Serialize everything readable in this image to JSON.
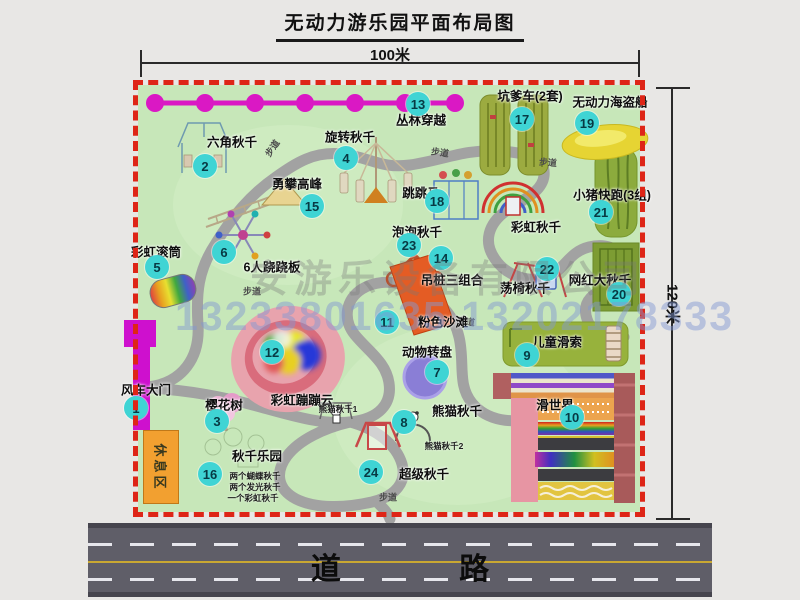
{
  "header": {
    "title": "无动力游乐园平面布局图"
  },
  "dimensions": {
    "width_label": "100米",
    "height_label": "120米"
  },
  "watermark": {
    "company": "安游乐设备有限公司",
    "phone": "13233801635 13202178333"
  },
  "road": {
    "label": "道 路"
  },
  "colors": {
    "badge": "#3fd4d4",
    "border_red": "#de2517",
    "park_green": "#c7e7b9",
    "gate_magenta": "#ce10ce",
    "road_gray": "#5f5e68",
    "rest_orange": "#f2a030"
  },
  "park": {
    "rest_area_label": "休息区",
    "walkway_label": "步道",
    "attractions": [
      {
        "num": "1",
        "label": "风车大门",
        "badge": {
          "x": -2,
          "y": 323
        },
        "label_pos": {
          "x": 8,
          "y": 304
        }
      },
      {
        "num": "2",
        "label": "六角秋千",
        "badge": {
          "x": 67,
          "y": 81
        },
        "label_pos": {
          "x": 94,
          "y": 56
        }
      },
      {
        "num": "3",
        "label": "樱花树",
        "badge": {
          "x": 79,
          "y": 336
        },
        "label_pos": {
          "x": 86,
          "y": 319
        }
      },
      {
        "num": "4",
        "label": "旋转秋千",
        "badge": {
          "x": 208,
          "y": 73
        },
        "label_pos": {
          "x": 212,
          "y": 51
        }
      },
      {
        "num": "5",
        "label": "彩虹滚筒",
        "badge": {
          "x": 19,
          "y": 182
        },
        "label_pos": {
          "x": 18,
          "y": 166
        }
      },
      {
        "num": "6",
        "label": "6人跷跷板",
        "badge": {
          "x": 86,
          "y": 167
        },
        "label_pos": {
          "x": 134,
          "y": 181
        }
      },
      {
        "num": "7",
        "label": "动物转盘",
        "badge": {
          "x": 299,
          "y": 287
        },
        "label_pos": {
          "x": 289,
          "y": 266
        }
      },
      {
        "num": "8",
        "label": "熊猫秋千",
        "badge": {
          "x": 266,
          "y": 337
        },
        "label_pos": {
          "x": 319,
          "y": 325
        }
      },
      {
        "num": "9",
        "label": "儿童滑索",
        "badge": {
          "x": 389,
          "y": 270
        },
        "label_pos": {
          "x": 419,
          "y": 256
        }
      },
      {
        "num": "10",
        "label": "滑世界",
        "badge": {
          "x": 434,
          "y": 332
        },
        "label_pos": {
          "x": 417,
          "y": 319
        }
      },
      {
        "num": "11",
        "label": "粉色沙滩",
        "badge": {
          "x": 249,
          "y": 237
        },
        "label_pos": {
          "x": 305,
          "y": 236
        }
      },
      {
        "num": "12",
        "label": "彩虹蹦蹦云",
        "badge": {
          "x": 134,
          "y": 267
        },
        "label_pos": {
          "x": 164,
          "y": 314
        }
      },
      {
        "num": "13",
        "label": "丛林穿越",
        "badge": {
          "x": 280,
          "y": 19
        },
        "label_pos": {
          "x": 283,
          "y": 34
        }
      },
      {
        "num": "14",
        "label": "吊桩三组合",
        "badge": {
          "x": 303,
          "y": 173
        },
        "label_pos": {
          "x": 314,
          "y": 194
        }
      },
      {
        "num": "15",
        "label": "勇攀高峰",
        "badge": {
          "x": 174,
          "y": 121
        },
        "label_pos": {
          "x": 159,
          "y": 98
        }
      },
      {
        "num": "16",
        "label": "秋千乐园",
        "badge": {
          "x": 72,
          "y": 389
        },
        "label_pos": {
          "x": 119,
          "y": 370
        }
      },
      {
        "num": "17",
        "label": "坑爹车(2套)",
        "badge": {
          "x": 384,
          "y": 34
        },
        "label_pos": {
          "x": 392,
          "y": 10
        }
      },
      {
        "num": "18",
        "label": "跳跳马",
        "badge": {
          "x": 299,
          "y": 116
        },
        "label_pos": {
          "x": 283,
          "y": 107
        }
      },
      {
        "num": "19",
        "label": "无动力海盗船",
        "badge": {
          "x": 449,
          "y": 38
        },
        "label_pos": {
          "x": 472,
          "y": 16
        }
      },
      {
        "num": "20",
        "label": "网红大秋千",
        "badge": {
          "x": 481,
          "y": 209
        },
        "label_pos": {
          "x": 462,
          "y": 194
        }
      },
      {
        "num": "21",
        "label": "小猪快跑(3组)",
        "badge": {
          "x": 463,
          "y": 127
        },
        "label_pos": {
          "x": 474,
          "y": 109
        }
      },
      {
        "num": "22",
        "label": "荡椅秋千",
        "badge": {
          "x": 409,
          "y": 184
        },
        "label_pos": {
          "x": 387,
          "y": 202
        }
      },
      {
        "num": "23",
        "label": "泡泡秋千",
        "badge": {
          "x": 271,
          "y": 160
        },
        "label_pos": {
          "x": 279,
          "y": 146
        }
      },
      {
        "num": "24",
        "label": "超级秋千",
        "badge": {
          "x": 233,
          "y": 387
        },
        "label_pos": {
          "x": 286,
          "y": 388
        }
      },
      {
        "num": null,
        "label": "彩虹秋千",
        "badge": null,
        "label_pos": {
          "x": 398,
          "y": 141
        }
      }
    ],
    "annotations": [
      {
        "text": "熊猫秋千1",
        "x": 200,
        "y": 324
      },
      {
        "text": "熊猫秋千2",
        "x": 306,
        "y": 361
      },
      {
        "text": "两个蝴蝶秋千",
        "x": 117,
        "y": 391
      },
      {
        "text": "两个发光秋千",
        "x": 117,
        "y": 402
      },
      {
        "text": "一个彩虹秋千",
        "x": 115,
        "y": 413
      }
    ]
  }
}
